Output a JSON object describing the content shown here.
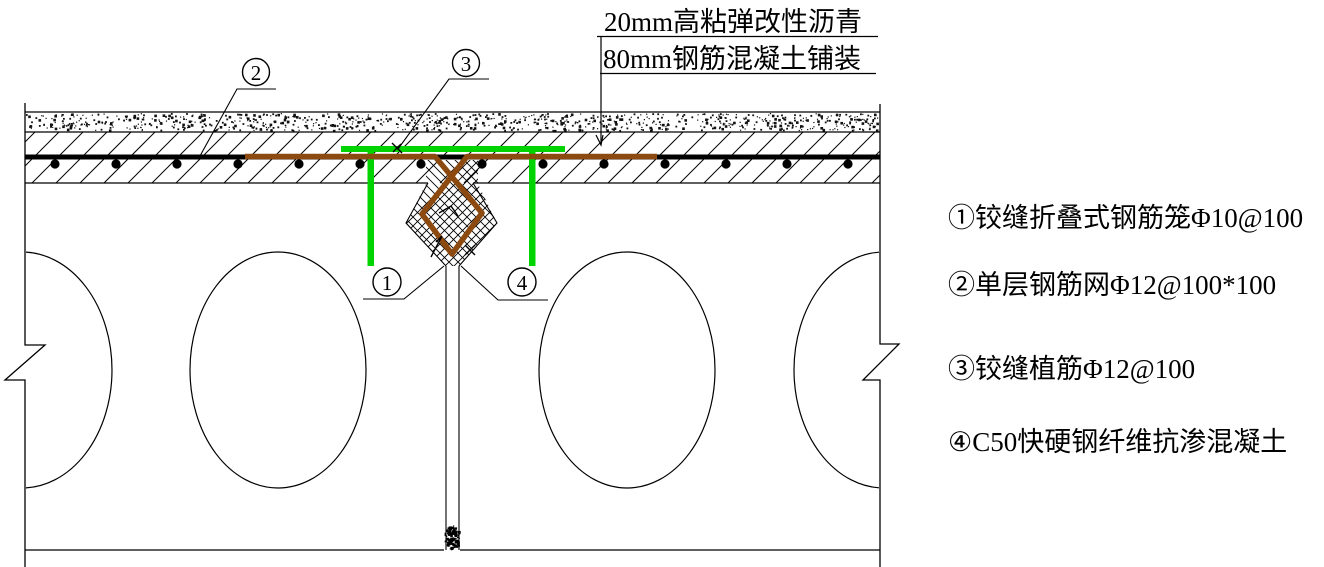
{
  "drawing": {
    "title": "铰缝构造大样",
    "top_labels": {
      "line1": "20mm高粘弹改性沥青",
      "line2": "80mm钢筋混凝土铺装"
    },
    "callouts": {
      "c1": "1",
      "c2": "2",
      "c3": "3",
      "c4": "4"
    },
    "legend": {
      "items": [
        {
          "label": "①铰缝折叠式钢筋笼Φ10@100"
        },
        {
          "label": "②单层钢筋网Φ12@100*100"
        },
        {
          "label": "③铰缝植筋Φ12@100"
        },
        {
          "label": "④C50快硬钢纤维抗渗混凝土"
        }
      ]
    },
    "colors": {
      "planted_rebar_green": "#00d400",
      "rebar_cage_brown": "#8c4a10",
      "line_black": "#000000"
    }
  }
}
